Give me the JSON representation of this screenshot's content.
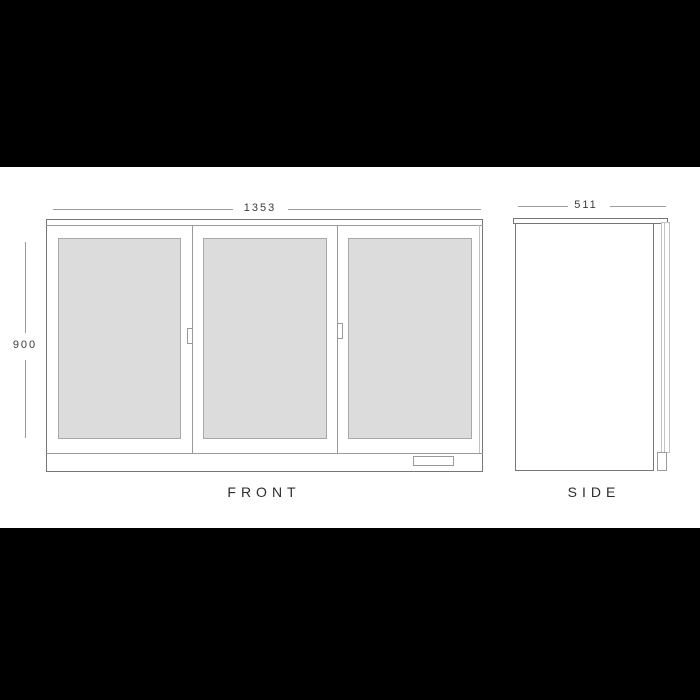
{
  "colors": {
    "letterbox": "#000000",
    "canvas": "#ffffff",
    "line-dark": "#767676",
    "line-mid": "#9a9a9a",
    "line-light": "#c2c2c2",
    "glass-fill": "#dcdcdc",
    "glass-border": "#a8a8a8",
    "text-color": "#2d2d2d",
    "dim-line": "#9b9b9b"
  },
  "front_view": {
    "label": "FRONT",
    "width_dim": "1353",
    "height_dim": "900",
    "door_count": 3
  },
  "side_view": {
    "label": "SIDE",
    "depth_dim": "511"
  }
}
